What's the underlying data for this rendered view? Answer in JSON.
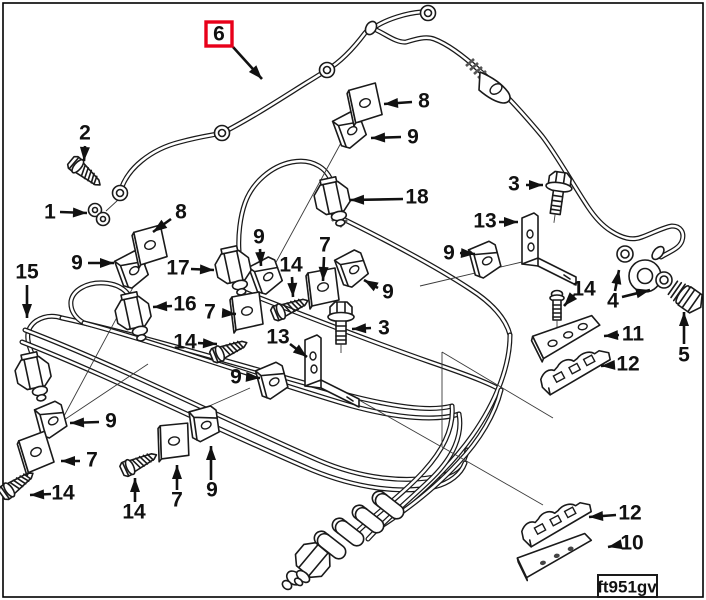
{
  "figure": {
    "stamp": "ft951gv",
    "highlight_color": "#e8001a",
    "line_color": "#1a1a1a",
    "background": "#ffffff"
  },
  "diagram": {
    "labels": [
      {
        "text": "6",
        "x": 219,
        "y": 34,
        "boxed": true,
        "arrows": [
          [
            233,
            47,
            262,
            79
          ]
        ]
      },
      {
        "text": "2",
        "x": 85,
        "y": 133,
        "arrows": [
          [
            85,
            146,
            84,
            161
          ]
        ]
      },
      {
        "text": "1",
        "x": 50,
        "y": 212,
        "arrows": [
          [
            60,
            212,
            87,
            213
          ]
        ]
      },
      {
        "text": "8",
        "x": 181,
        "y": 212,
        "arrows": [
          [
            171,
            219,
            153,
            232
          ]
        ]
      },
      {
        "text": "9",
        "x": 77,
        "y": 263,
        "arrows": [
          [
            88,
            263,
            114,
            263
          ]
        ]
      },
      {
        "text": "15",
        "x": 27,
        "y": 272,
        "arrows": [
          [
            27,
            285,
            27,
            318
          ]
        ]
      },
      {
        "text": "17",
        "x": 178,
        "y": 268,
        "arrows": [
          [
            191,
            269,
            214,
            270
          ]
        ]
      },
      {
        "text": "9",
        "x": 259,
        "y": 237,
        "arrows": [
          [
            260,
            249,
            261,
            266
          ]
        ]
      },
      {
        "text": "14",
        "x": 291,
        "y": 265,
        "arrows": [
          [
            292,
            277,
            293,
            297
          ]
        ]
      },
      {
        "text": "7",
        "x": 325,
        "y": 245,
        "arrows": [
          [
            324,
            257,
            323,
            281
          ]
        ]
      },
      {
        "text": "8",
        "x": 424,
        "y": 101,
        "arrows": [
          [
            412,
            102,
            384,
            104
          ]
        ]
      },
      {
        "text": "9",
        "x": 413,
        "y": 137,
        "arrows": [
          [
            401,
            137,
            371,
            138
          ]
        ]
      },
      {
        "text": "18",
        "x": 417,
        "y": 197,
        "arrows": [
          [
            403,
            199,
            350,
            200
          ]
        ]
      },
      {
        "text": "3",
        "x": 514,
        "y": 184,
        "arrows": [
          [
            526,
            185,
            543,
            185
          ]
        ]
      },
      {
        "text": "13",
        "x": 485,
        "y": 221,
        "arrows": [
          [
            499,
            222,
            518,
            222
          ]
        ]
      },
      {
        "text": "9",
        "x": 449,
        "y": 253,
        "arrows": [
          [
            460,
            253,
            475,
            254
          ]
        ]
      },
      {
        "text": "9",
        "x": 388,
        "y": 292,
        "arrows": [
          [
            378,
            288,
            364,
            280
          ]
        ]
      },
      {
        "text": "16",
        "x": 185,
        "y": 304,
        "arrows": [
          [
            172,
            306,
            153,
            307
          ]
        ]
      },
      {
        "text": "7",
        "x": 210,
        "y": 312,
        "arrows": [
          [
            222,
            313,
            236,
            314
          ]
        ]
      },
      {
        "text": "14",
        "x": 185,
        "y": 342,
        "arrows": [
          [
            198,
            343,
            217,
            344
          ]
        ]
      },
      {
        "text": "3",
        "x": 384,
        "y": 328,
        "arrows": [
          [
            371,
            328,
            352,
            329
          ]
        ]
      },
      {
        "text": "13",
        "x": 278,
        "y": 337,
        "arrows": [
          [
            290,
            344,
            307,
            357
          ]
        ]
      },
      {
        "text": "9",
        "x": 236,
        "y": 377,
        "arrows": [
          [
            248,
            377,
            260,
            378
          ]
        ]
      },
      {
        "text": "14",
        "x": 584,
        "y": 289,
        "arrows": [
          [
            574,
            295,
            564,
            306
          ]
        ]
      },
      {
        "text": "11",
        "x": 633,
        "y": 334,
        "arrows": [
          [
            619,
            335,
            604,
            336
          ]
        ]
      },
      {
        "text": "12",
        "x": 628,
        "y": 364,
        "arrows": [
          [
            614,
            365,
            601,
            366
          ]
        ]
      },
      {
        "text": "4",
        "x": 613,
        "y": 301,
        "arrows": [
          [
            615,
            291,
            619,
            270
          ],
          [
            622,
            297,
            650,
            290
          ]
        ]
      },
      {
        "text": "5",
        "x": 684,
        "y": 355,
        "arrows": [
          [
            684,
            344,
            684,
            312
          ]
        ]
      },
      {
        "text": "9",
        "x": 111,
        "y": 421,
        "arrows": [
          [
            99,
            422,
            70,
            423
          ]
        ]
      },
      {
        "text": "7",
        "x": 92,
        "y": 460,
        "arrows": [
          [
            80,
            461,
            61,
            461
          ]
        ]
      },
      {
        "text": "14",
        "x": 63,
        "y": 493,
        "arrows": [
          [
            51,
            494,
            30,
            495
          ]
        ]
      },
      {
        "text": "14",
        "x": 134,
        "y": 512,
        "arrows": [
          [
            135,
            502,
            135,
            478
          ]
        ]
      },
      {
        "text": "7",
        "x": 177,
        "y": 500,
        "arrows": [
          [
            177,
            490,
            177,
            465
          ]
        ]
      },
      {
        "text": "9",
        "x": 212,
        "y": 490,
        "arrows": [
          [
            211,
            480,
            211,
            446
          ]
        ]
      },
      {
        "text": "12",
        "x": 630,
        "y": 513,
        "arrows": [
          [
            616,
            515,
            589,
            517
          ]
        ]
      },
      {
        "text": "10",
        "x": 632,
        "y": 543,
        "arrows": [
          [
            618,
            545,
            608,
            547
          ]
        ]
      }
    ],
    "leaders": [
      [
        348,
        130,
        262,
        288
      ],
      [
        152,
        252,
        64,
        416
      ],
      [
        64,
        420,
        148,
        364
      ],
      [
        522,
        262,
        420,
        286
      ],
      [
        442,
        352,
        553,
        418
      ],
      [
        442,
        352,
        442,
        447
      ],
      [
        442,
        447,
        543,
        505
      ],
      [
        198,
        411,
        250,
        388
      ],
      [
        352,
        396,
        440,
        446
      ],
      [
        118,
        200,
        106,
        211
      ]
    ],
    "parts": [
      {
        "type": "eyelet",
        "x": 120,
        "y": 193,
        "r": 0
      },
      {
        "type": "eyelet",
        "x": 222,
        "y": 133,
        "r": 0
      },
      {
        "type": "eyelet",
        "x": 327,
        "y": 70,
        "r": 0
      },
      {
        "type": "eyelet",
        "x": 428,
        "y": 13,
        "r": 0
      },
      {
        "type": "washer",
        "x": 625,
        "y": 254,
        "r": 0
      },
      {
        "type": "washer",
        "x": 664,
        "y": 280,
        "r": 0
      },
      {
        "type": "grommet",
        "x": 99,
        "y": 214,
        "r": 0
      },
      {
        "type": "clamp",
        "x": 132,
        "y": 271,
        "r": -20
      },
      {
        "type": "clamp",
        "x": 350,
        "y": 131,
        "r": -20
      },
      {
        "type": "clamp",
        "x": 266,
        "y": 277,
        "r": -20
      },
      {
        "type": "clamp",
        "x": 352,
        "y": 270,
        "r": -20
      },
      {
        "type": "clamp",
        "x": 485,
        "y": 261,
        "r": -15
      },
      {
        "type": "clamp",
        "x": 272,
        "y": 382,
        "r": -15
      },
      {
        "type": "clamp",
        "x": 51,
        "y": 421,
        "r": -15
      },
      {
        "type": "clamp",
        "x": 204,
        "y": 425,
        "r": -8
      },
      {
        "type": "plate",
        "x": 150,
        "y": 245,
        "r": -5
      },
      {
        "type": "plate",
        "x": 365,
        "y": 103,
        "r": -5
      },
      {
        "type": "plate",
        "x": 323,
        "y": 287,
        "r": 0
      },
      {
        "type": "plate",
        "x": 247,
        "y": 311,
        "r": 0
      },
      {
        "type": "plate",
        "x": 36,
        "y": 452,
        "r": -10
      },
      {
        "type": "plate",
        "x": 174,
        "y": 441,
        "r": 5
      },
      {
        "type": "screw",
        "x": 87,
        "y": 174,
        "r": 40
      },
      {
        "type": "screw",
        "x": 292,
        "y": 307,
        "r": -22
      },
      {
        "type": "screw",
        "x": 231,
        "y": 349,
        "r": -22
      },
      {
        "type": "screw",
        "x": 19,
        "y": 483,
        "r": -35
      },
      {
        "type": "screw",
        "x": 141,
        "y": 462,
        "r": -25
      },
      {
        "type": "bolt",
        "x": 557,
        "y": 201,
        "r": 8
      },
      {
        "type": "bolt",
        "x": 341,
        "y": 331,
        "r": 0
      },
      {
        "type": "smallbolt",
        "x": 557,
        "y": 308,
        "r": 0
      },
      {
        "type": "nut",
        "x": 33,
        "y": 373,
        "r": -12
      },
      {
        "type": "nut",
        "x": 133,
        "y": 313,
        "r": -12
      },
      {
        "type": "nut",
        "x": 233,
        "y": 267,
        "r": -12
      },
      {
        "type": "nut",
        "x": 332,
        "y": 198,
        "r": -12
      },
      {
        "type": "nut",
        "x": 313,
        "y": 560,
        "r": 40
      },
      {
        "type": "bracket",
        "x": 548,
        "y": 245,
        "r": 0
      },
      {
        "type": "bracket",
        "x": 331,
        "y": 367,
        "r": 0
      },
      {
        "type": "bar11",
        "x": 568,
        "y": 339,
        "r": -12
      },
      {
        "type": "iso12",
        "x": 576,
        "y": 372,
        "r": -12
      },
      {
        "type": "iso12",
        "x": 557,
        "y": 524,
        "r": -12
      },
      {
        "type": "plate10",
        "x": 556,
        "y": 557,
        "r": -12
      },
      {
        "type": "elbow",
        "x": 388,
        "y": 505,
        "r": 38
      },
      {
        "type": "elbow",
        "x": 368,
        "y": 519,
        "r": 38
      },
      {
        "type": "elbow",
        "x": 348,
        "y": 532,
        "r": 38
      },
      {
        "type": "elbow",
        "x": 330,
        "y": 545,
        "r": 38
      }
    ]
  }
}
